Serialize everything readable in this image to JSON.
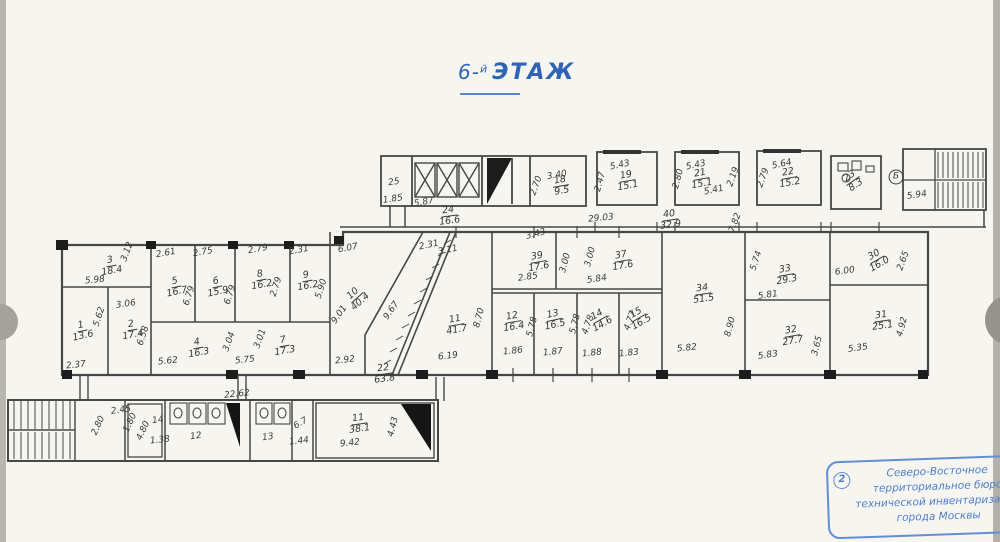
{
  "title": {
    "prefix": "6-",
    "sup": "й",
    "word": "ЭТАЖ"
  },
  "stamp": {
    "number": "2",
    "lines": [
      "Северо-Восточное",
      "территориальное бюро",
      "технической инвентаризации",
      "города Москвы"
    ]
  },
  "colors": {
    "ink": "#3b3b3b",
    "title_blue": "#2f63b5",
    "stamp_blue": "#4d7fcd",
    "paper": "#f6f5f0"
  },
  "rooms": [
    {
      "n": "3",
      "a": "18.4",
      "x": 111,
      "y": 266,
      "r": -10
    },
    {
      "n": "5",
      "a": "16.7",
      "x": 176,
      "y": 287,
      "r": -12
    },
    {
      "n": "6",
      "a": "15.9",
      "x": 217,
      "y": 287,
      "r": -12
    },
    {
      "n": "1",
      "a": "13.6",
      "x": 82,
      "y": 331,
      "r": -12
    },
    {
      "n": "2",
      "a": "17.4",
      "x": 132,
      "y": 330,
      "r": -10
    },
    {
      "n": "4",
      "a": "16.3",
      "x": 198,
      "y": 348,
      "r": -10
    },
    {
      "n": "7",
      "a": "17.3",
      "x": 284,
      "y": 346,
      "r": -10
    },
    {
      "n": "8",
      "a": "16.2",
      "x": 261,
      "y": 280,
      "r": -10
    },
    {
      "n": "9",
      "a": "16.2",
      "x": 307,
      "y": 281,
      "r": -10
    },
    {
      "n": "10",
      "a": "40.4",
      "x": 357,
      "y": 298,
      "r": -42
    },
    {
      "n": "11",
      "a": "41.7",
      "x": 456,
      "y": 325,
      "r": -10
    },
    {
      "n": "12",
      "a": "16.4",
      "x": 513,
      "y": 322,
      "r": -10
    },
    {
      "n": "13",
      "a": "16.5",
      "x": 554,
      "y": 320,
      "r": -12
    },
    {
      "n": "14",
      "a": "14.6",
      "x": 600,
      "y": 320,
      "r": -30
    },
    {
      "n": "15",
      "a": "16.5",
      "x": 639,
      "y": 318,
      "r": -30
    },
    {
      "n": "34",
      "a": "51.5",
      "x": 703,
      "y": 294,
      "r": -8
    },
    {
      "n": "33",
      "a": "29.3",
      "x": 786,
      "y": 275,
      "r": -10
    },
    {
      "n": "32",
      "a": "27.7",
      "x": 792,
      "y": 336,
      "r": -10
    },
    {
      "n": "30",
      "a": "16.0",
      "x": 877,
      "y": 260,
      "r": -30
    },
    {
      "n": "31",
      "a": "25.1",
      "x": 882,
      "y": 321,
      "r": -8
    },
    {
      "n": "18",
      "a": "9.5",
      "x": 561,
      "y": 186,
      "r": -10
    },
    {
      "n": "19",
      "a": "15.1",
      "x": 627,
      "y": 181,
      "r": -10
    },
    {
      "n": "21",
      "a": "15.1",
      "x": 701,
      "y": 179,
      "r": -10
    },
    {
      "n": "22",
      "a": "15.2",
      "x": 789,
      "y": 178,
      "r": -10
    },
    {
      "n": "23",
      "a": "8.3",
      "x": 853,
      "y": 181,
      "r": -35
    },
    {
      "n": "24",
      "a": "16.6",
      "x": 449,
      "y": 216,
      "r": -8
    },
    {
      "n": "40",
      "a": "32.9",
      "x": 670,
      "y": 220,
      "r": -8
    },
    {
      "n": "39",
      "a": "17.6",
      "x": 538,
      "y": 262,
      "r": -10
    },
    {
      "n": "37",
      "a": "17.6",
      "x": 622,
      "y": 261,
      "r": -10
    },
    {
      "n": "22",
      "a": "63.8",
      "x": 384,
      "y": 374,
      "r": -8
    },
    {
      "n": "11",
      "a": "38.1",
      "x": 359,
      "y": 424,
      "r": -8
    }
  ],
  "plain_labels": [
    {
      "t": "25",
      "x": 394,
      "y": 183,
      "r": -8
    },
    {
      "t": "Б",
      "x": 896,
      "y": 177,
      "r": 0,
      "circled": true
    },
    {
      "t": "14",
      "x": 158,
      "y": 421,
      "r": -8
    },
    {
      "t": "12",
      "x": 196,
      "y": 437,
      "r": -8
    },
    {
      "t": "13",
      "x": 268,
      "y": 438,
      "r": -8
    },
    {
      "t": "6.7",
      "x": 301,
      "y": 424,
      "r": -30
    }
  ],
  "dims": [
    {
      "t": "1.85",
      "x": 393,
      "y": 200,
      "r": -8
    },
    {
      "t": "5.87",
      "x": 424,
      "y": 203,
      "r": -10
    },
    {
      "t": "3.40",
      "x": 557,
      "y": 176,
      "r": -10
    },
    {
      "t": "2.70",
      "x": 537,
      "y": 186,
      "r": -70
    },
    {
      "t": "5.43",
      "x": 620,
      "y": 166,
      "r": -12
    },
    {
      "t": "2.47",
      "x": 601,
      "y": 182,
      "r": -75
    },
    {
      "t": "5.43",
      "x": 696,
      "y": 166,
      "r": -12
    },
    {
      "t": "2.80",
      "x": 679,
      "y": 179,
      "r": -75
    },
    {
      "t": "5.41",
      "x": 714,
      "y": 191,
      "r": -12
    },
    {
      "t": "2.19",
      "x": 734,
      "y": 177,
      "r": -70
    },
    {
      "t": "5.64",
      "x": 782,
      "y": 165,
      "r": -12
    },
    {
      "t": "2.79",
      "x": 764,
      "y": 178,
      "r": -70
    },
    {
      "t": "5.94",
      "x": 917,
      "y": 196,
      "r": -8
    },
    {
      "t": "29.03",
      "x": 601,
      "y": 219,
      "r": -6
    },
    {
      "t": "7.82",
      "x": 736,
      "y": 223,
      "r": -70
    },
    {
      "t": "3.43",
      "x": 536,
      "y": 235,
      "r": -14
    },
    {
      "t": "5.98",
      "x": 95,
      "y": 281,
      "r": -6
    },
    {
      "t": "3.12",
      "x": 128,
      "y": 252,
      "r": -70
    },
    {
      "t": "2.61",
      "x": 166,
      "y": 254,
      "r": -10
    },
    {
      "t": "2.75",
      "x": 203,
      "y": 253,
      "r": -10
    },
    {
      "t": "6.79",
      "x": 190,
      "y": 296,
      "r": -72
    },
    {
      "t": "6.79",
      "x": 231,
      "y": 295,
      "r": -72
    },
    {
      "t": "2.79",
      "x": 258,
      "y": 250,
      "r": -10
    },
    {
      "t": "2.79",
      "x": 277,
      "y": 287,
      "r": -72
    },
    {
      "t": "2.31",
      "x": 299,
      "y": 251,
      "r": -10
    },
    {
      "t": "5.90",
      "x": 322,
      "y": 289,
      "r": -72
    },
    {
      "t": "6.07",
      "x": 348,
      "y": 249,
      "r": -10
    },
    {
      "t": "9.01",
      "x": 340,
      "y": 315,
      "r": -55
    },
    {
      "t": "9.67",
      "x": 392,
      "y": 311,
      "r": -55
    },
    {
      "t": "2.31",
      "x": 429,
      "y": 246,
      "r": -12
    },
    {
      "t": "3.11",
      "x": 448,
      "y": 251,
      "r": -12
    },
    {
      "t": "3.06",
      "x": 126,
      "y": 305,
      "r": -8
    },
    {
      "t": "5.62",
      "x": 100,
      "y": 317,
      "r": -72
    },
    {
      "t": "6.58",
      "x": 144,
      "y": 336,
      "r": -72
    },
    {
      "t": "2.37",
      "x": 76,
      "y": 366,
      "r": -6
    },
    {
      "t": "5.62",
      "x": 168,
      "y": 362,
      "r": -6
    },
    {
      "t": "3.04",
      "x": 230,
      "y": 342,
      "r": -70
    },
    {
      "t": "3.01",
      "x": 261,
      "y": 339,
      "r": -70
    },
    {
      "t": "5.75",
      "x": 245,
      "y": 361,
      "r": -6
    },
    {
      "t": "2.92",
      "x": 345,
      "y": 361,
      "r": -6
    },
    {
      "t": "22.62",
      "x": 237,
      "y": 395,
      "r": -6
    },
    {
      "t": "8.70",
      "x": 480,
      "y": 318,
      "r": -75
    },
    {
      "t": "6.19",
      "x": 448,
      "y": 357,
      "r": -6
    },
    {
      "t": "2.85",
      "x": 528,
      "y": 278,
      "r": -8
    },
    {
      "t": "3.00",
      "x": 566,
      "y": 263,
      "r": -75
    },
    {
      "t": "3.00",
      "x": 591,
      "y": 257,
      "r": -75
    },
    {
      "t": "5.84",
      "x": 597,
      "y": 280,
      "r": -8
    },
    {
      "t": "5.78",
      "x": 533,
      "y": 327,
      "r": -75
    },
    {
      "t": "5.78",
      "x": 576,
      "y": 324,
      "r": -75
    },
    {
      "t": "4.78",
      "x": 589,
      "y": 325,
      "r": -70
    },
    {
      "t": "4.77",
      "x": 631,
      "y": 321,
      "r": -70
    },
    {
      "t": "1.86",
      "x": 513,
      "y": 352,
      "r": -6
    },
    {
      "t": "1.87",
      "x": 553,
      "y": 353,
      "r": -6
    },
    {
      "t": "1.88",
      "x": 592,
      "y": 354,
      "r": -6
    },
    {
      "t": "1.83",
      "x": 629,
      "y": 354,
      "r": -6
    },
    {
      "t": "5.82",
      "x": 687,
      "y": 349,
      "r": -6
    },
    {
      "t": "8.90",
      "x": 731,
      "y": 327,
      "r": -75
    },
    {
      "t": "5.81",
      "x": 768,
      "y": 296,
      "r": -8
    },
    {
      "t": "5.74",
      "x": 757,
      "y": 261,
      "r": -72
    },
    {
      "t": "5.83",
      "x": 768,
      "y": 356,
      "r": -8
    },
    {
      "t": "3.65",
      "x": 818,
      "y": 346,
      "r": -75
    },
    {
      "t": "6.00",
      "x": 845,
      "y": 272,
      "r": -8
    },
    {
      "t": "2.65",
      "x": 904,
      "y": 261,
      "r": -70
    },
    {
      "t": "5.35",
      "x": 858,
      "y": 349,
      "r": -8
    },
    {
      "t": "4.92",
      "x": 903,
      "y": 327,
      "r": -75
    },
    {
      "t": "2.45",
      "x": 121,
      "y": 411,
      "r": -8
    },
    {
      "t": "2.80",
      "x": 99,
      "y": 426,
      "r": -65
    },
    {
      "t": "1.80",
      "x": 131,
      "y": 423,
      "r": -65
    },
    {
      "t": "4.80",
      "x": 144,
      "y": 431,
      "r": -65
    },
    {
      "t": "1.38",
      "x": 160,
      "y": 441,
      "r": -6
    },
    {
      "t": "1.44",
      "x": 299,
      "y": 442,
      "r": -6
    },
    {
      "t": "9.42",
      "x": 350,
      "y": 444,
      "r": -6
    },
    {
      "t": "4.43",
      "x": 394,
      "y": 427,
      "r": -75
    }
  ]
}
